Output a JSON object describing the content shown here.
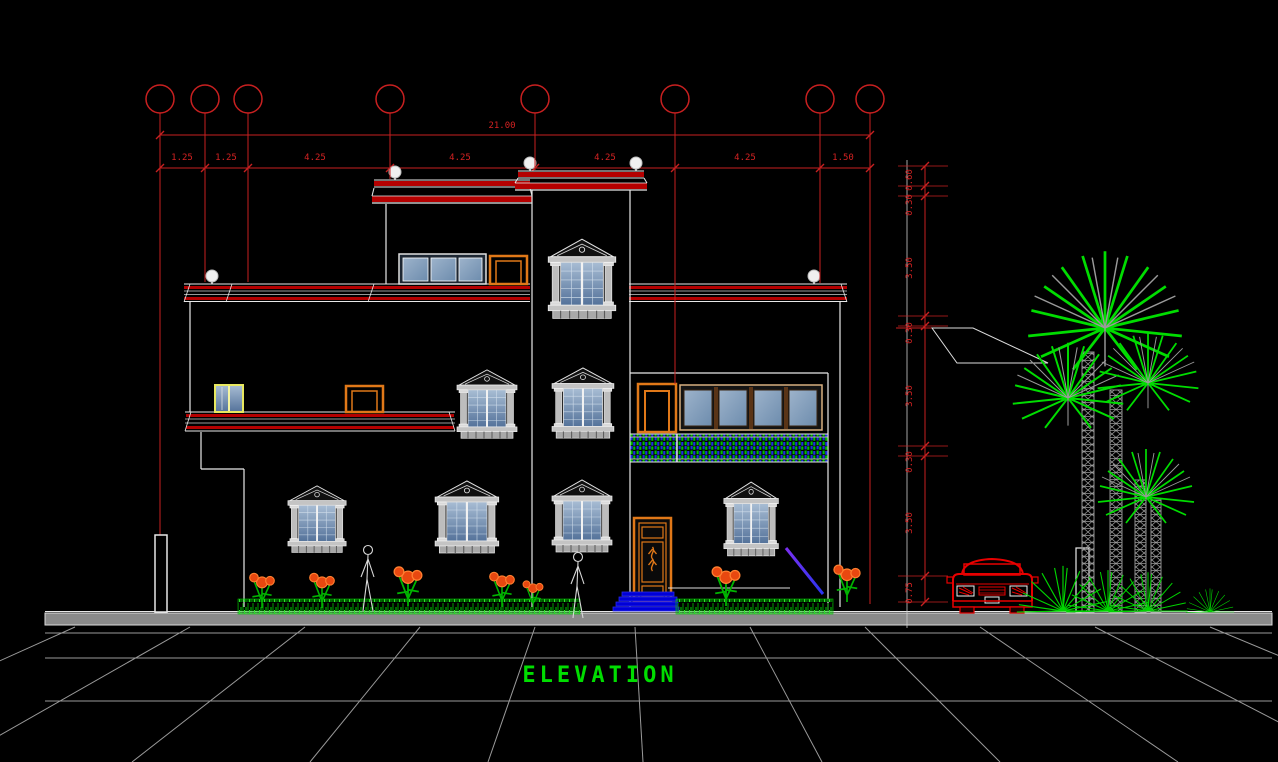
{
  "drawing": {
    "title": "ELEVATION",
    "total_width_dim": "21.00",
    "width_dims": [
      "1.25",
      "1.25",
      "4.25",
      "4.25",
      "4.25",
      "4.25",
      "1.50"
    ],
    "height_dims": [
      "0.60",
      "0.30",
      "3.50",
      "0.30",
      "3.50",
      "0.30",
      "3.50",
      "0.75"
    ],
    "colors": {
      "background": "#000000",
      "dimension_red": "#d42222",
      "outline_white": "#e8e8e8",
      "cornice_red": "#b40000",
      "accent_orange": "#e07818",
      "glass_blue": "#7d97b5",
      "vegetation_green": "#00d400",
      "railing_purple": "#5a2ee0",
      "step_blue": "#0000d8",
      "car_red": "#e80000",
      "street_gray": "#8a8a8a",
      "title_green": "#00dd00",
      "yellow_frame": "#e8e860"
    }
  }
}
